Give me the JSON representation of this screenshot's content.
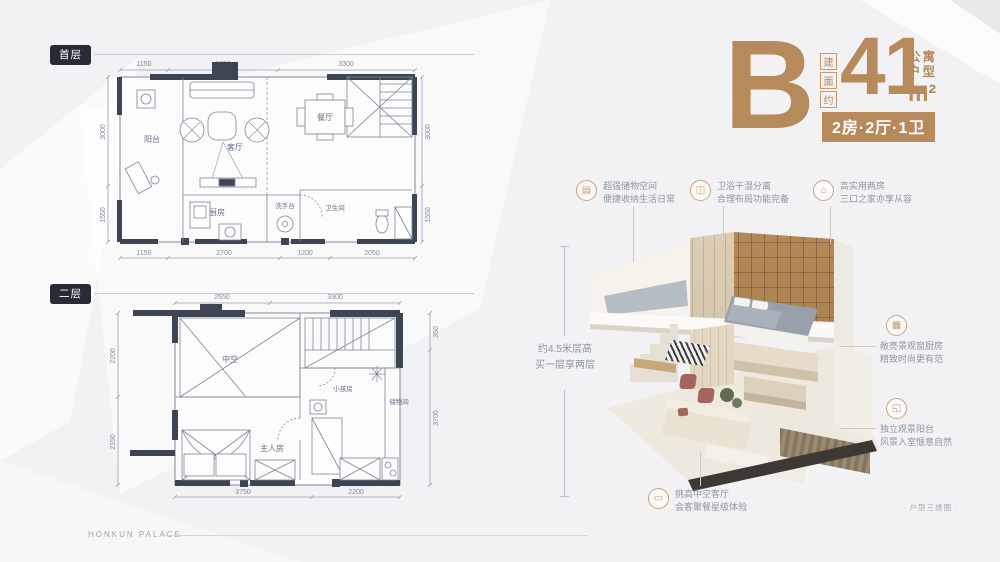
{
  "page": {
    "brand": "HONKUN PALACE",
    "disclaimer": "· 户型三维图 ·"
  },
  "unit": {
    "letter": "B",
    "area_prefix": [
      "建",
      "面",
      "约"
    ],
    "area_value": "41",
    "area_unit": "m²",
    "type_lines": [
      "公寓",
      "户型"
    ],
    "spec": "2房·2厅·1卫"
  },
  "floors": {
    "first": {
      "label": "首层",
      "rooms": {
        "balcony": "阳台",
        "living": "客厅",
        "dining": "餐厅",
        "kitchen": "厨房",
        "washstand": "洗手台",
        "bathroom": "卫生间"
      },
      "dims": {
        "top": [
          "1150",
          "2650",
          "3300"
        ],
        "bottom": [
          "1150",
          "2700",
          "1200",
          "2050"
        ],
        "left": [
          "3000",
          "1550"
        ],
        "right": [
          "3000",
          "1550"
        ]
      }
    },
    "second": {
      "label": "二层",
      "rooms": {
        "void": "中空",
        "kids": "小孩房",
        "storage": "储物间",
        "master": "主人房"
      },
      "dims": {
        "top": [
          "2650",
          "3300"
        ],
        "bottom": [
          "3750",
          "2200"
        ],
        "left": [
          "2200",
          "2150"
        ],
        "right": [
          "350",
          "3700"
        ]
      }
    }
  },
  "height_note": {
    "line1": "约4.5米层高",
    "line2": "买一层享两层"
  },
  "annotations": [
    {
      "name": "storage",
      "glyph": "▤",
      "line1": "超强储物空间",
      "line2": "便捷收纳生活日常"
    },
    {
      "name": "bathroom",
      "glyph": "◫",
      "line1": "卫浴干湿分离",
      "line2": "合理布局功能完备"
    },
    {
      "name": "two-rooms",
      "glyph": "⌂",
      "line1": "高实用两房",
      "line2": "三口之家亦享从容"
    },
    {
      "name": "kitchen",
      "glyph": "▦",
      "line1": "敞亮景观窗厨房",
      "line2": "精致时尚更有范"
    },
    {
      "name": "balcony",
      "glyph": "◱",
      "line1": "独立观景阳台",
      "line2": "风景入室惬意自然"
    },
    {
      "name": "living",
      "glyph": "▭",
      "line1": "挑高中空客厅",
      "line2": "会客聚餐星级体验"
    }
  ],
  "colors": {
    "accent": "#b78a5c",
    "badge_dark": "#262b37",
    "wall": "#3e4552",
    "dim_text": "#828c9c"
  }
}
